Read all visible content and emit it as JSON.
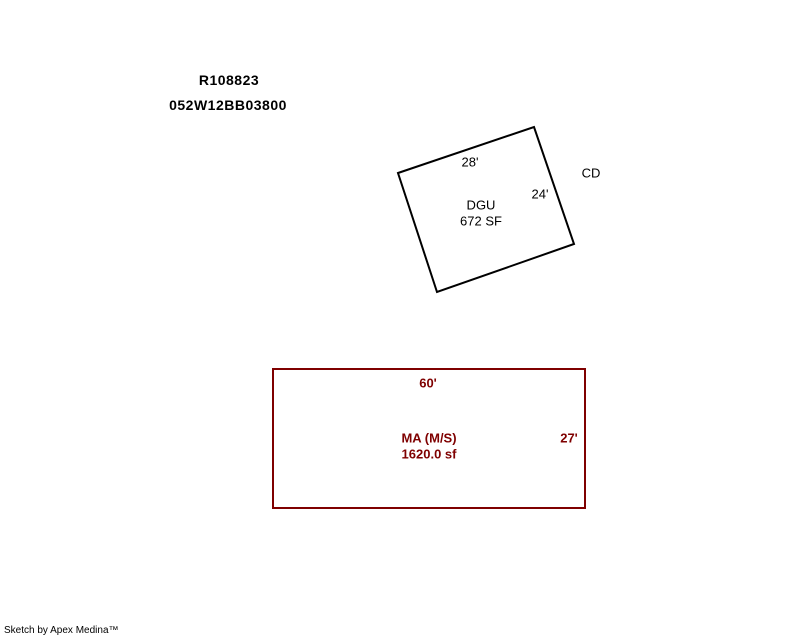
{
  "header": {
    "parcel_id": "R108823",
    "map_taxlot": "052W12BB03800"
  },
  "sketch": {
    "colors": {
      "dgu_outline": "#000000",
      "ma_outline": "#7f0000",
      "ma_text": "#7f0000"
    },
    "dgu": {
      "name": "DGU",
      "area": "672 SF",
      "top_dim": "28'",
      "right_dim": "24'",
      "side_note": "CD"
    },
    "ma": {
      "name": "MA (M/S)",
      "area": "1620.0 sf",
      "top_dim": "60'",
      "right_dim": "27'"
    }
  },
  "footer": {
    "credit": "Sketch by Apex Medina™"
  }
}
